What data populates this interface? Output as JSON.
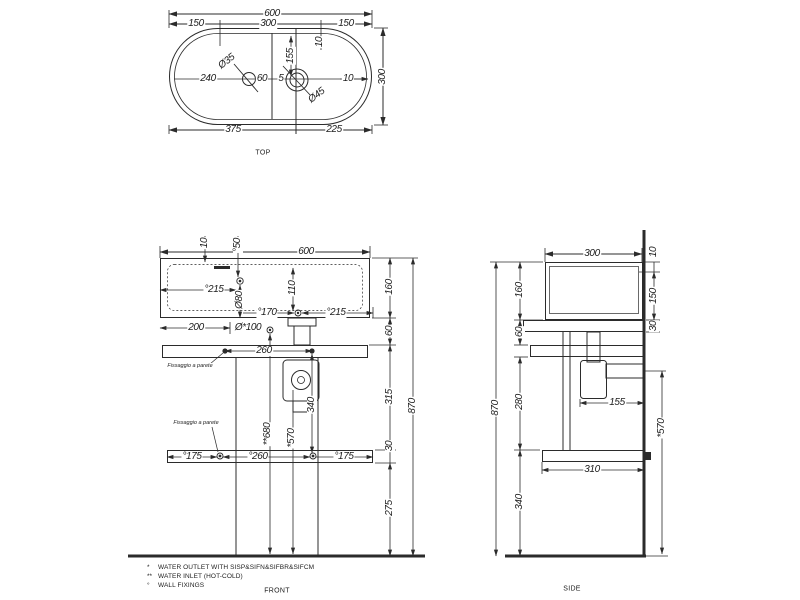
{
  "views": {
    "top": {
      "title": "TOP",
      "title_pos": {
        "x": 263,
        "y": 153
      },
      "labels": [
        {
          "t": "600",
          "x": 272,
          "y": 14
        },
        {
          "t": "150",
          "x": 196,
          "y": 24
        },
        {
          "t": "300",
          "x": 268,
          "y": 24
        },
        {
          "t": "150",
          "x": 346,
          "y": 24
        },
        {
          "t": "10",
          "x": 320,
          "y": 42,
          "r": "r90"
        },
        {
          "t": "155",
          "x": 291,
          "y": 56,
          "r": "r90"
        },
        {
          "t": "Ø35",
          "x": 227,
          "y": 62,
          "r": "r38"
        },
        {
          "t": "240",
          "x": 208,
          "y": 79
        },
        {
          "t": "60",
          "x": 262,
          "y": 79
        },
        {
          "t": "5",
          "x": 281,
          "y": 79
        },
        {
          "t": "10",
          "x": 348,
          "y": 79
        },
        {
          "t": "Ø45",
          "x": 317,
          "y": 96,
          "r": "r38"
        },
        {
          "t": "300",
          "x": 383,
          "y": 77,
          "r": "r90"
        },
        {
          "t": "375",
          "x": 233,
          "y": 130
        },
        {
          "t": "225",
          "x": 334,
          "y": 130
        }
      ]
    },
    "front": {
      "title": "FRONT",
      "title_pos": {
        "x": 277,
        "y": 591
      },
      "labels": [
        {
          "t": "10",
          "x": 205,
          "y": 243,
          "r": "r90"
        },
        {
          "t": "°50",
          "x": 238,
          "y": 245,
          "r": "r90"
        },
        {
          "t": "600",
          "x": 306,
          "y": 252
        },
        {
          "t": "°215",
          "x": 214,
          "y": 290
        },
        {
          "t": "Ø80",
          "x": 240,
          "y": 300,
          "r": "r90"
        },
        {
          "t": "110",
          "x": 293,
          "y": 288,
          "r": "r90"
        },
        {
          "t": "°170",
          "x": 267,
          "y": 313
        },
        {
          "t": "°215",
          "x": 336,
          "y": 313
        },
        {
          "t": "200",
          "x": 196,
          "y": 328
        },
        {
          "t": "Ø*100",
          "x": 248,
          "y": 328
        },
        {
          "t": "260",
          "x": 264,
          "y": 351
        },
        {
          "t": "Fissaggio a parete",
          "x": 190,
          "y": 366,
          "s": "small"
        },
        {
          "t": "Fissaggio a parete",
          "x": 196,
          "y": 423,
          "s": "small"
        },
        {
          "t": "**680",
          "x": 268,
          "y": 434,
          "r": "r90"
        },
        {
          "t": "*570",
          "x": 292,
          "y": 438,
          "r": "r90"
        },
        {
          "t": "340",
          "x": 312,
          "y": 405,
          "r": "r90"
        },
        {
          "t": "°175",
          "x": 192,
          "y": 457
        },
        {
          "t": "°260",
          "x": 258,
          "y": 457
        },
        {
          "t": "°175",
          "x": 344,
          "y": 457
        },
        {
          "t": "160",
          "x": 390,
          "y": 287,
          "r": "r90"
        },
        {
          "t": "60",
          "x": 390,
          "y": 331,
          "r": "r90"
        },
        {
          "t": "315",
          "x": 390,
          "y": 397,
          "r": "r90"
        },
        {
          "t": "30",
          "x": 390,
          "y": 446,
          "r": "r90"
        },
        {
          "t": "275",
          "x": 390,
          "y": 508,
          "r": "r90"
        },
        {
          "t": "870",
          "x": 413,
          "y": 406,
          "r": "r90"
        }
      ]
    },
    "side": {
      "title": "SIDE",
      "title_pos": {
        "x": 572,
        "y": 589
      },
      "labels": [
        {
          "t": "300",
          "x": 592,
          "y": 254
        },
        {
          "t": "10",
          "x": 654,
          "y": 252,
          "r": "r90"
        },
        {
          "t": "150",
          "x": 654,
          "y": 296,
          "r": "r90"
        },
        {
          "t": "30",
          "x": 654,
          "y": 326,
          "r": "r90"
        },
        {
          "t": "160",
          "x": 520,
          "y": 290,
          "r": "r90"
        },
        {
          "t": "60",
          "x": 520,
          "y": 332,
          "r": "r90"
        },
        {
          "t": "280",
          "x": 520,
          "y": 402,
          "r": "r90"
        },
        {
          "t": "340",
          "x": 520,
          "y": 502,
          "r": "r90"
        },
        {
          "t": "870",
          "x": 496,
          "y": 408,
          "r": "r90"
        },
        {
          "t": "155",
          "x": 617,
          "y": 403
        },
        {
          "t": "*570",
          "x": 662,
          "y": 428,
          "r": "r90"
        },
        {
          "t": "310",
          "x": 592,
          "y": 470
        }
      ]
    }
  },
  "footnotes": [
    {
      "marker": "*",
      "text": "WATER OUTLET WITH SISP&SIFN&SIFBR&SIFCM"
    },
    {
      "marker": "**",
      "text": "WATER INLET  (HOT-COLD)"
    },
    {
      "marker": "°",
      "text": "WALL FIXINGS"
    }
  ],
  "colors": {
    "line": "#2b2b2b",
    "background": "#ffffff"
  }
}
